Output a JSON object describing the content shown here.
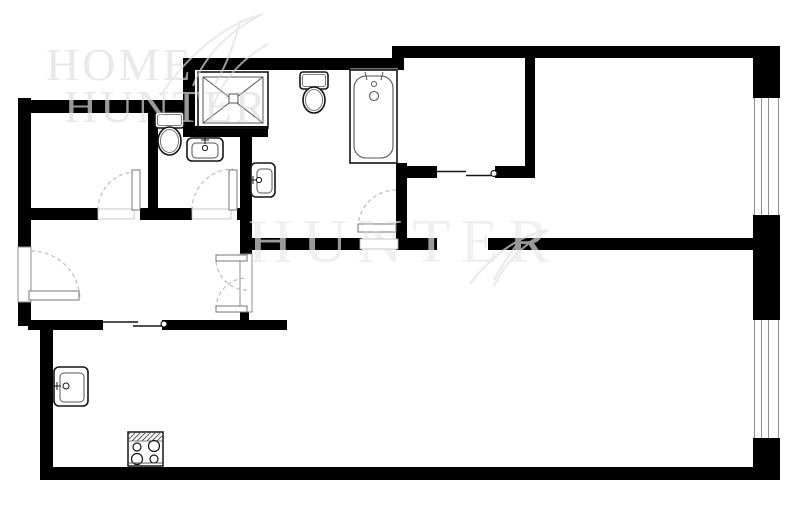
{
  "colors": {
    "bg": "#ffffff",
    "wall": "#000000",
    "stroke": "#151515",
    "mid": "#555555",
    "frame": "#8f8f8f",
    "dash": "#bdbdbd",
    "mullion": "#8f8f8f",
    "thin": "#9d9d9d",
    "leaf_stroke": "#777777"
  },
  "watermark": {
    "logo": {
      "line1": "HOME",
      "line2": "HUNTER",
      "pos1": [
        46,
        80
      ],
      "pos2": [
        64,
        122
      ],
      "size": 46,
      "spacing": 3
    },
    "center": {
      "text": "HUNTER",
      "pos": [
        248,
        262
      ],
      "size": 62,
      "spacing": 10
    },
    "feathers": [
      "M160 96 C190 52 226 24 263 14",
      "M263 14 C234 28 206 52 193 86",
      "M268 44 C243 58 221 80 211 112",
      "M240 20 C236 40 228 62 214 86",
      "M470 284 C494 252 520 236 548 230",
      "M548 230 C524 244 504 264 494 286",
      "M520 240 C510 254 500 268 494 280"
    ],
    "under_color": "#e9e9e9",
    "center_under_color": "#f0f0f0",
    "over_color": "#999999"
  },
  "floorplan": {
    "walls": [
      [
        183,
        58,
        213,
        12
      ],
      [
        392,
        46,
        388,
        12
      ],
      [
        392,
        46,
        12,
        24
      ],
      [
        753,
        46,
        27,
        52
      ],
      [
        753,
        215,
        27,
        105
      ],
      [
        753,
        438,
        27,
        42
      ],
      [
        40,
        467,
        740,
        13
      ],
      [
        40,
        322,
        13,
        150
      ],
      [
        28,
        320,
        75,
        10
      ],
      [
        162,
        320,
        125,
        10
      ],
      [
        18,
        98,
        13,
        149
      ],
      [
        18,
        302,
        13,
        24
      ],
      [
        18,
        100,
        165,
        13
      ],
      [
        183,
        58,
        12,
        78
      ],
      [
        183,
        126,
        85,
        11
      ],
      [
        240,
        130,
        12,
        125
      ],
      [
        240,
        311,
        9,
        15
      ],
      [
        148,
        113,
        10,
        97
      ],
      [
        31,
        208,
        67,
        12
      ],
      [
        140,
        208,
        52,
        12
      ],
      [
        237,
        208,
        15,
        12
      ],
      [
        252,
        238,
        110,
        12
      ],
      [
        396,
        238,
        41,
        12
      ],
      [
        396,
        163,
        11,
        87
      ],
      [
        396,
        166,
        41,
        12
      ],
      [
        495,
        166,
        40,
        12
      ],
      [
        525,
        57,
        10,
        121
      ],
      [
        488,
        238,
        265,
        12
      ]
    ],
    "windows": [
      {
        "rect": [
          753,
          98,
          27,
          117
        ],
        "mullions": [
          754.5,
          761.5,
          768.5,
          778.5
        ]
      },
      {
        "rect": [
          753,
          320,
          27,
          118
        ],
        "mullions": [
          754.5,
          761.5,
          768.5,
          778.5
        ]
      }
    ],
    "pocket_doors": [
      {
        "name": "closet-sliding-door",
        "l1": [
          437,
          171.5,
          466,
          171.5
        ],
        "l2": [
          466,
          175.5,
          493,
          175.5
        ],
        "knob": [
          494,
          173.5,
          3
        ]
      },
      {
        "name": "kitchen-sliding-door",
        "l1": [
          103,
          322,
          138,
          322
        ],
        "l2": [
          133,
          326,
          163,
          326
        ],
        "knob": [
          164,
          324,
          3
        ]
      }
    ],
    "swing_doors": [
      {
        "name": "bedroom1-door",
        "threshold": [
          98,
          209,
          36,
          10
        ],
        "leaf": [
          132,
          170,
          8,
          40
        ],
        "arc": {
          "cx": 136,
          "cy": 210,
          "r": 38,
          "a1": 180,
          "a2": 270
        }
      },
      {
        "name": "wc-door",
        "threshold": [
          192,
          209,
          39,
          10
        ],
        "leaf": [
          229,
          170,
          8,
          40
        ],
        "arc": {
          "cx": 233,
          "cy": 210,
          "r": 41,
          "a1": 180,
          "a2": 270
        }
      },
      {
        "name": "bathroom-door",
        "threshold": [
          360,
          239,
          38,
          10
        ],
        "leaf": [
          358,
          224,
          38,
          8
        ],
        "arc": {
          "cx": 396,
          "cy": 228,
          "r": 38,
          "a1": 180,
          "a2": 270
        }
      },
      {
        "name": "entry-door",
        "frame": [
          18,
          247,
          13,
          55
        ],
        "leaf": [
          29,
          291,
          50,
          9
        ],
        "arc": {
          "cx": 31,
          "cy": 300,
          "r": 49,
          "a1": 270,
          "a2": 360
        }
      },
      {
        "name": "double-door-top",
        "frame": [
          240,
          254,
          12,
          58
        ],
        "leaf": [
          216,
          255,
          31,
          6
        ],
        "arc": {
          "cx": 247,
          "cy": 259,
          "r": 31,
          "a1": 90,
          "a2": 180
        }
      },
      {
        "name": "double-door-bottom",
        "leaf": [
          216,
          306,
          31,
          6
        ],
        "arc": {
          "cx": 247,
          "cy": 309,
          "r": 31,
          "a1": 180,
          "a2": 270
        }
      }
    ],
    "fixtures": {
      "shower": {
        "outer": [
          198,
          72,
          70,
          56
        ],
        "inner": [
          203,
          77,
          60,
          46
        ],
        "drain": [
          229,
          94,
          9,
          9
        ]
      },
      "toilets": [
        {
          "tank": [
            300,
            72,
            28,
            17
          ],
          "bowl": [
            314,
            100,
            11,
            13
          ]
        },
        {
          "tank": [
            155,
            112,
            29,
            16
          ],
          "bowl": [
            169.5,
            141,
            11.5,
            14
          ]
        }
      ],
      "tub": {
        "outer": [
          350,
          70,
          47,
          93
        ],
        "inner": [
          354,
          76,
          39,
          82
        ],
        "top_line": [
          350,
          69,
          398,
          69
        ],
        "spout": [
          374,
          84,
          2.5
        ],
        "drain": [
          374,
          96,
          4.5
        ],
        "handles": [
          [
            365,
            72,
            367,
            80
          ],
          [
            383,
            72,
            381,
            80
          ]
        ]
      },
      "sinks": [
        {
          "outer": [
            187,
            138,
            36,
            23
          ],
          "inner": [
            192,
            143,
            26,
            15
          ],
          "fc": [
            205,
            148,
            2.6
          ],
          "tap": [
            205,
            140
          ]
        },
        {
          "outer": [
            251,
            163,
            24,
            34
          ],
          "inner": [
            257,
            169,
            15,
            24
          ],
          "fc": [
            259,
            180,
            2.6
          ],
          "tap": [
            253,
            180
          ]
        },
        {
          "outer": [
            54,
            367,
            34,
            39
          ],
          "inner": [
            60,
            373,
            24,
            29
          ],
          "fc": [
            66,
            386,
            3
          ],
          "tap": [
            57,
            386
          ]
        }
      ],
      "stove": {
        "body": [
          128,
          432,
          35,
          34
        ],
        "hatch": [
          128,
          432,
          35,
          9
        ],
        "burners": [
          [
            137,
            447,
            4
          ],
          [
            154,
            446,
            5.5
          ],
          [
            137,
            459,
            5.5
          ],
          [
            154,
            459,
            4
          ]
        ],
        "front_line": [
          129,
          463,
          162,
          463
        ]
      }
    }
  }
}
